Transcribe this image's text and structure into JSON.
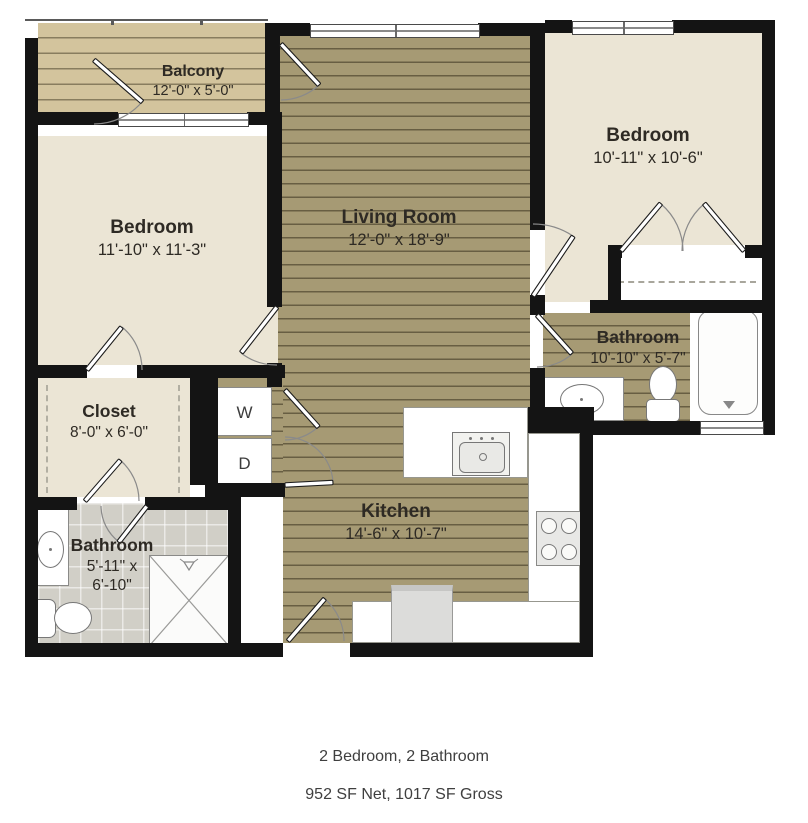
{
  "footer": {
    "title": "2 Bedroom, 2 Bathroom",
    "subtitle": "952 SF Net, 1017 SF Gross"
  },
  "rooms": {
    "balcony": {
      "name": "Balcony",
      "dims": "12'-0\" x 5'-0\""
    },
    "bedroom_left": {
      "name": "Bedroom",
      "dims": "11'-10\" x 11'-3\""
    },
    "living_room": {
      "name": "Living Room",
      "dims": "12'-0\" x 18'-9\""
    },
    "bedroom_right": {
      "name": "Bedroom",
      "dims": "10'-11\" x 10'-6\""
    },
    "bathroom_right": {
      "name": "Bathroom",
      "dims": "10'-10\" x 5'-7\""
    },
    "closet": {
      "name": "Closet",
      "dims": "8'-0\" x 6'-0\""
    },
    "kitchen": {
      "name": "Kitchen",
      "dims": "14'-6\" x 10'-7\""
    },
    "bathroom_left": {
      "name": "Bathroom",
      "dims_line1": "5'-11\" x",
      "dims_line2": "6'-10\""
    }
  },
  "laundry": {
    "washer_label": "W",
    "dryer_label": "D"
  },
  "colors": {
    "wall": "#141414",
    "wood": "#a69a74",
    "balcony_wood": "#d3c49d",
    "cream": "#ebe5d5",
    "tile": "#d1cfc7",
    "fixture_white": "#ffffff",
    "label_text": "#2e2a24",
    "title_text": "#3f3f3f"
  }
}
